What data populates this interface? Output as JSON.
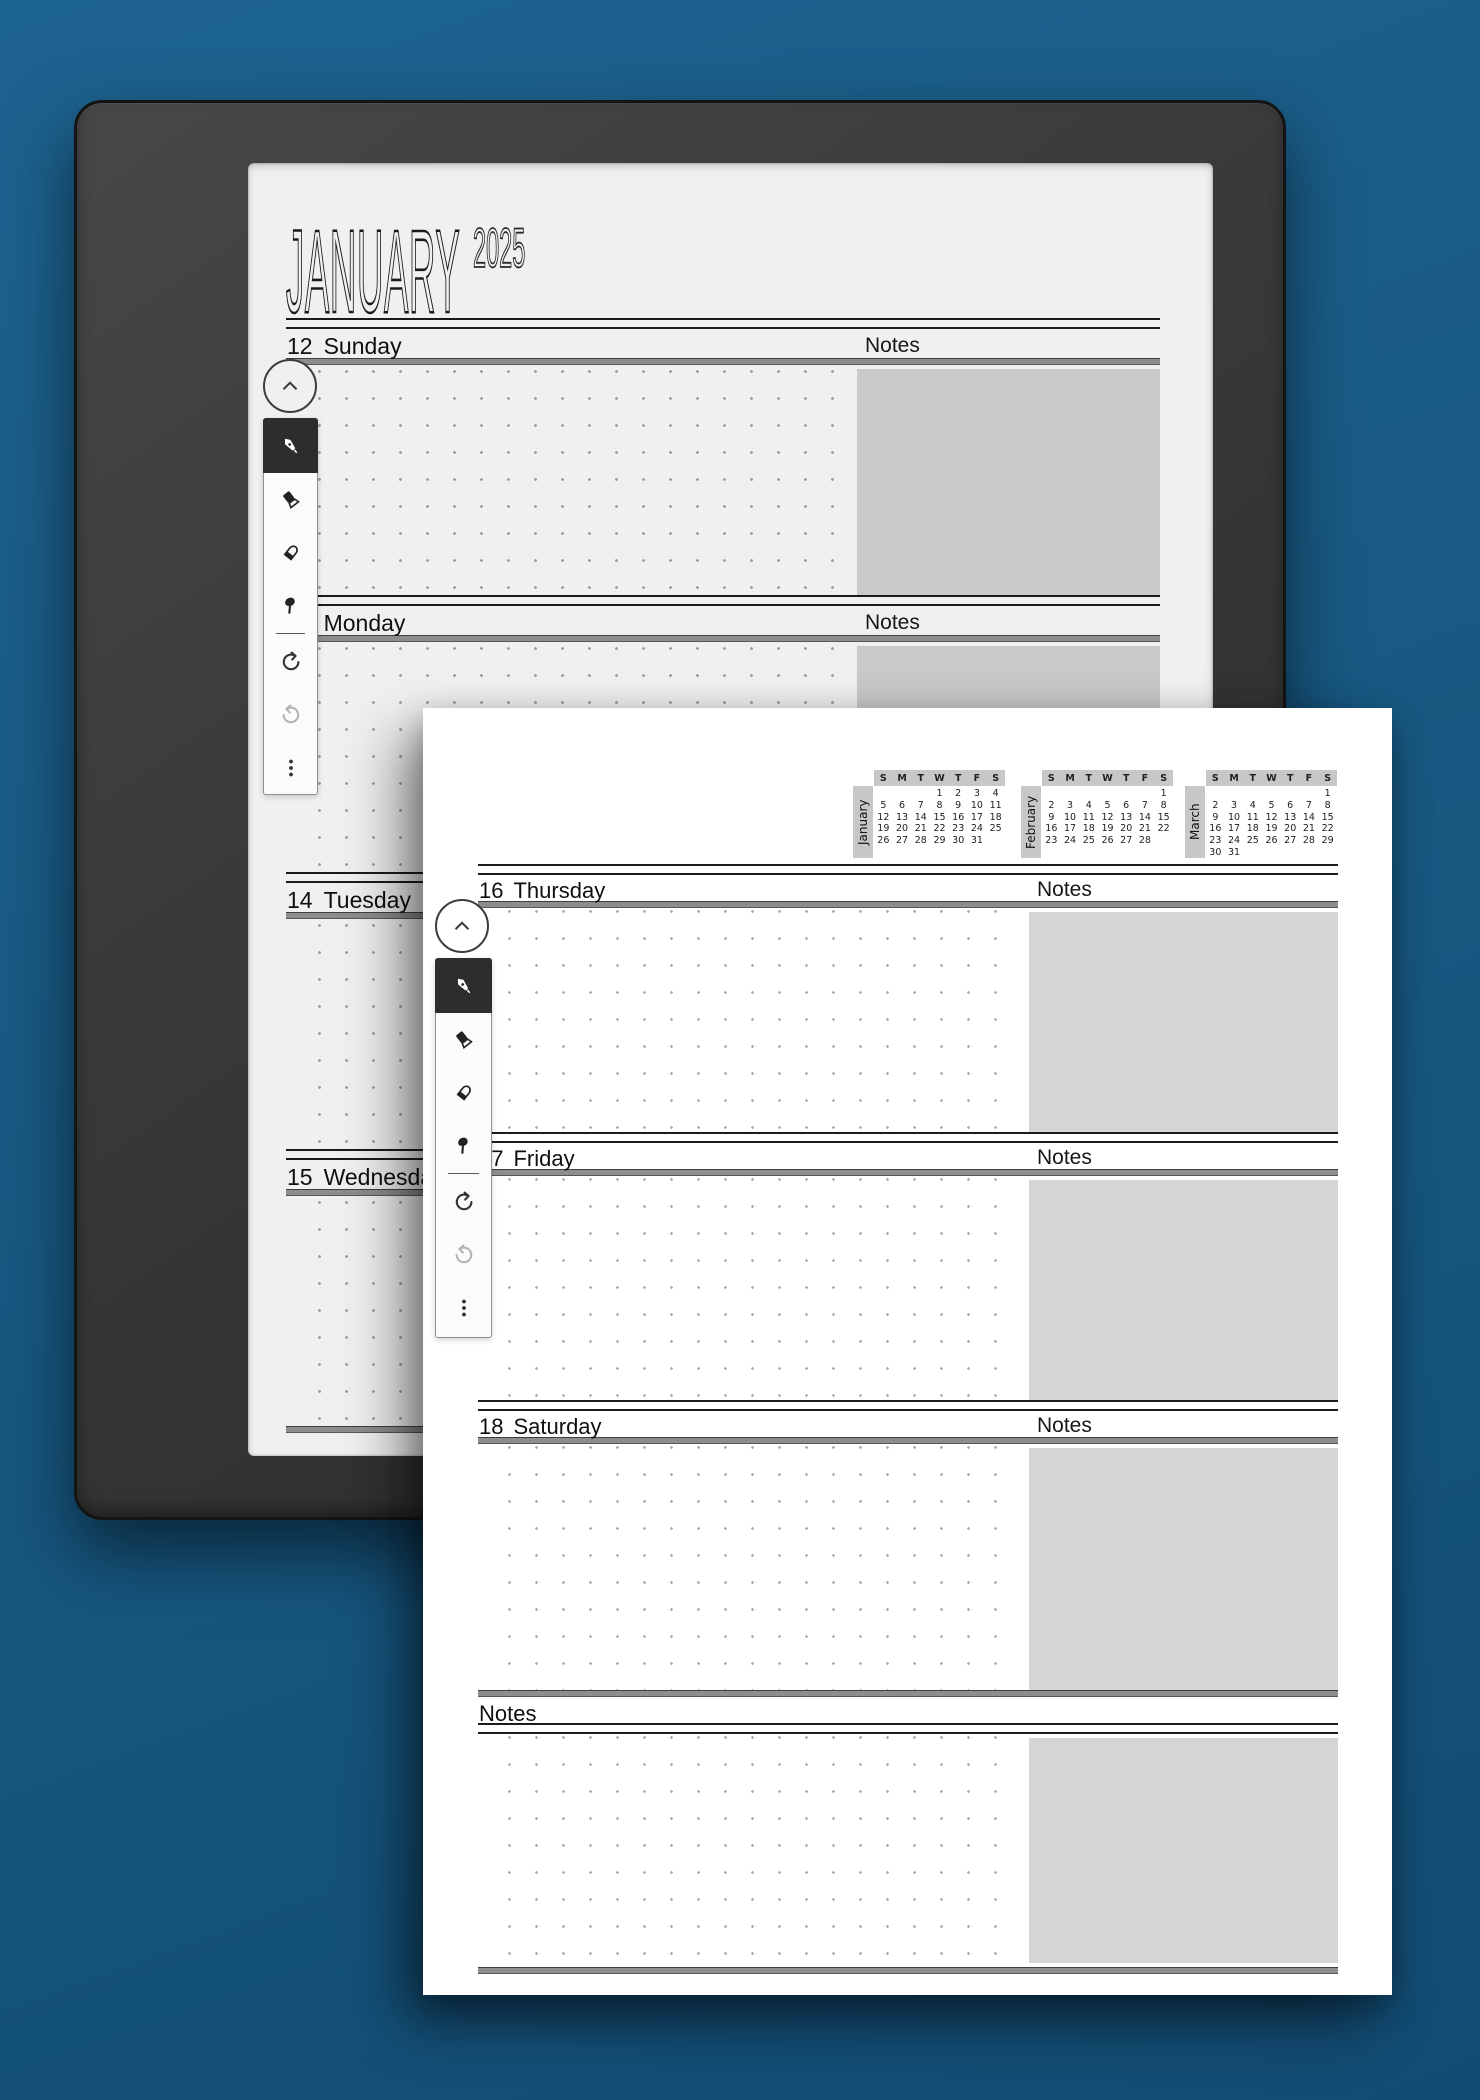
{
  "colors": {
    "background_blue": "#175780",
    "device_bezel": "#353535",
    "device_page": "#f1f0ee",
    "overlay_page": "#ffffff",
    "notes_box_device": "#c9c9c9",
    "notes_box_overlay": "#d5d5d5",
    "selected_tool_bg": "#2d2d2d",
    "calendar_strip": "#c7c7c7"
  },
  "device_page": {
    "title": "JANUARY",
    "year": "2025",
    "notes_label": "Notes",
    "sections": [
      {
        "num": "12",
        "name": "Sunday"
      },
      {
        "num": "13",
        "name": "Monday"
      },
      {
        "num": "14",
        "name": "Tuesday"
      },
      {
        "num": "15",
        "name": "Wednesday"
      }
    ]
  },
  "overlay_page": {
    "weekdays": [
      "S",
      "M",
      "T",
      "W",
      "T",
      "F",
      "S"
    ],
    "calendars": [
      {
        "name": "January",
        "days": [
          "",
          "",
          "",
          "1",
          "2",
          "3",
          "4",
          "5",
          "6",
          "7",
          "8",
          "9",
          "10",
          "11",
          "12",
          "13",
          "14",
          "15",
          "16",
          "17",
          "18",
          "19",
          "20",
          "21",
          "22",
          "23",
          "24",
          "25",
          "26",
          "27",
          "28",
          "29",
          "30",
          "31",
          "",
          "",
          "",
          "",
          "",
          "",
          ""
        ]
      },
      {
        "name": "February",
        "days": [
          "",
          "",
          "",
          "",
          "",
          "",
          "1",
          "2",
          "3",
          "4",
          "5",
          "6",
          "7",
          "8",
          "9",
          "10",
          "11",
          "12",
          "13",
          "14",
          "15",
          "16",
          "17",
          "18",
          "19",
          "20",
          "21",
          "22",
          "23",
          "24",
          "25",
          "26",
          "27",
          "28",
          "",
          "",
          "",
          "",
          "",
          "",
          ""
        ]
      },
      {
        "name": "March",
        "days": [
          "",
          "",
          "",
          "",
          "",
          "",
          "1",
          "2",
          "3",
          "4",
          "5",
          "6",
          "7",
          "8",
          "9",
          "10",
          "11",
          "12",
          "13",
          "14",
          "15",
          "16",
          "17",
          "18",
          "19",
          "20",
          "21",
          "22",
          "23",
          "24",
          "25",
          "26",
          "27",
          "28",
          "29",
          "30",
          "31",
          "",
          "",
          "",
          "",
          ""
        ]
      }
    ],
    "sections": [
      {
        "num": "16",
        "name": "Thursday"
      },
      {
        "num": "17",
        "name": "Friday"
      },
      {
        "num": "18",
        "name": "Saturday"
      }
    ],
    "notes_label": "Notes",
    "bottom_notes_label": "Notes"
  },
  "toolbar": {
    "tools": [
      "pen",
      "highlighter",
      "eraser",
      "lasso",
      "undo",
      "redo",
      "more"
    ],
    "collapse": "chevron-up"
  }
}
